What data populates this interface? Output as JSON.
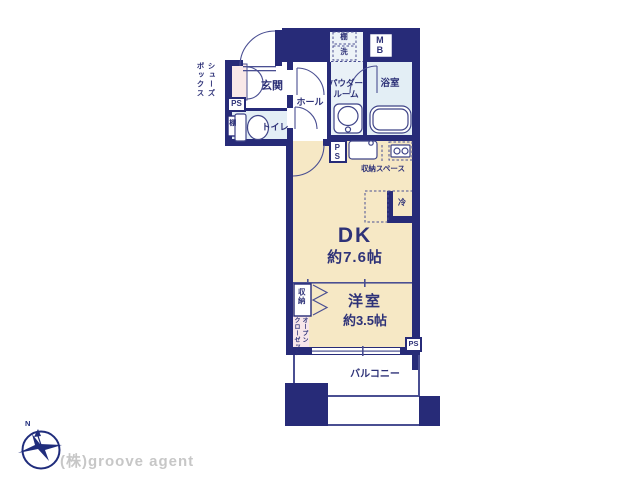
{
  "rooms": {
    "entrance": "玄関",
    "hall": "ホール",
    "toilet": "トイレ",
    "powder_room_line1": "パウダー",
    "powder_room_line2": "ルーム",
    "bath": "浴室",
    "dk": "DK",
    "dk_area": "約7.6帖",
    "western_room": "洋室",
    "western_room_area": "約3.5帖",
    "balcony": "バルコニー"
  },
  "annotations": {
    "shoes_box_line1": "シューズ",
    "shoes_box_line2": "ボックス",
    "shelf": "棚",
    "washer": "洗",
    "meter_box": "MB",
    "pipe_space": "PS",
    "toilet_shelf": "棚",
    "storage_space": "収納スペース",
    "refrigerator": "冷",
    "closet": "収納",
    "open_closet_line1": "オープン",
    "open_closet_line2": "クローゼット"
  },
  "footer": {
    "company": "(株)groove agent",
    "compass_north": "N"
  },
  "colors": {
    "wall": "#272b78",
    "thin_line": "#4a4f92",
    "floor_main": "#f6e8c5",
    "floor_wet": "#e3eef5",
    "floor_pink": "#f9e8e8",
    "label_text": "#2e3278",
    "logo_navy": "#202d7c",
    "logo_gray": "#c7c7c7"
  }
}
